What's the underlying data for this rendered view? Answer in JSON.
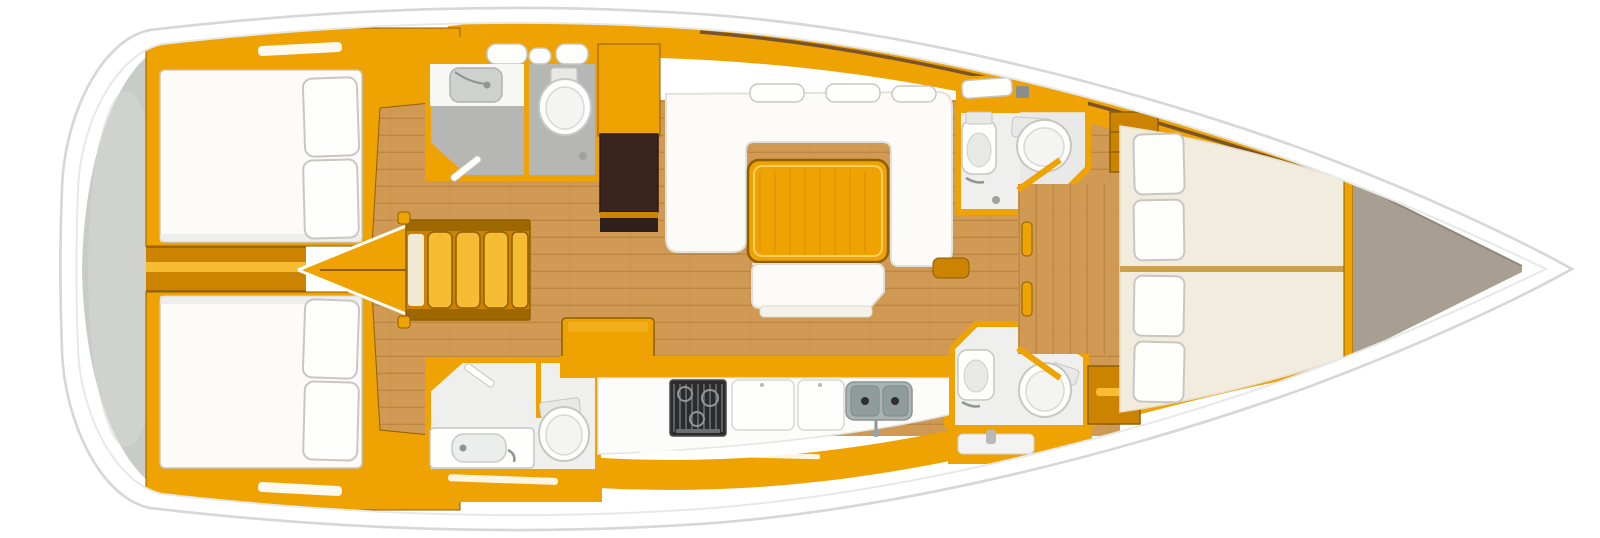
{
  "meta": {
    "description": "Top-view interior layout floor plan of a sailing yacht, bow pointing right",
    "view": "plan-top-down",
    "orientation": "bow-right",
    "text_labels_visible": false
  },
  "colors": {
    "hull_white": "#ffffff",
    "hull_stroke": "#d5d8d6",
    "deck_line": "#e7e9e8",
    "stern_gray": "#c8cbc6",
    "stern_gray_light": "#d6d8d4",
    "amber": "#efa303",
    "amber_deep": "#cc8400",
    "amber_dark": "#8f5e00",
    "amber_light": "#f7bc33",
    "teak": "#d09a54",
    "teak_line": "#bd8743",
    "cream_berth": "#f2ecdf",
    "bow_taupe": "#a79f92",
    "bath_wall": "#efefed",
    "bath_floor": "#b6b7b5",
    "berth_white": "#fcfbf7",
    "pillow_line": "#c9c7c0",
    "fixture_white": "#fefefc",
    "fixture_gray": "#e8e9e7",
    "fixture_line": "#c6c6c2",
    "dark_brown": "#3a241e",
    "stove_black": "#2c2c2c",
    "grate_gray": "#8f9696",
    "sink_gray": "#aab3b1",
    "sink_bowl": "#8f9c9a",
    "wood_trim_brown": "#6e4a2c"
  },
  "regions": {
    "stern_platform": {
      "fixtures": [
        "swim-platform"
      ]
    },
    "aft_cabin_top": {
      "fixtures": [
        "double-berth",
        "pillows-2",
        "deck-hatch"
      ]
    },
    "aft_cabin_bottom": {
      "fixtures": [
        "double-berth",
        "pillows-2",
        "deck-hatch"
      ]
    },
    "companionway": {
      "fixtures": [
        "steps-4",
        "engine-cover-wedge"
      ]
    },
    "aft_head_top": {
      "fixtures": [
        "washbasins",
        "shower-tray",
        "toilet",
        "gray-floor"
      ]
    },
    "aft_head_bottom": {
      "fixtures": [
        "washbasin",
        "toilet",
        "counter"
      ]
    },
    "salon": {
      "fixtures": [
        "u-settee",
        "dining-table",
        "headrests-3",
        "bench-seat",
        "storage-cabinet-dark"
      ]
    },
    "galley": {
      "fixtures": [
        "stove-3-burner",
        "counter-lids-2",
        "double-sink",
        "faucet"
      ]
    },
    "forward_head_top": {
      "fixtures": [
        "washbasin",
        "toilet",
        "shelf-unit"
      ]
    },
    "forward_head_bottom": {
      "fixtures": [
        "washbasin",
        "toilet",
        "cabinet"
      ]
    },
    "forward_cabin": {
      "fixtures": [
        "v-berth",
        "pillows-4",
        "entry-floor",
        "door-posts"
      ]
    },
    "bow_locker": {
      "fixtures": [
        "anchor-locker"
      ]
    }
  }
}
